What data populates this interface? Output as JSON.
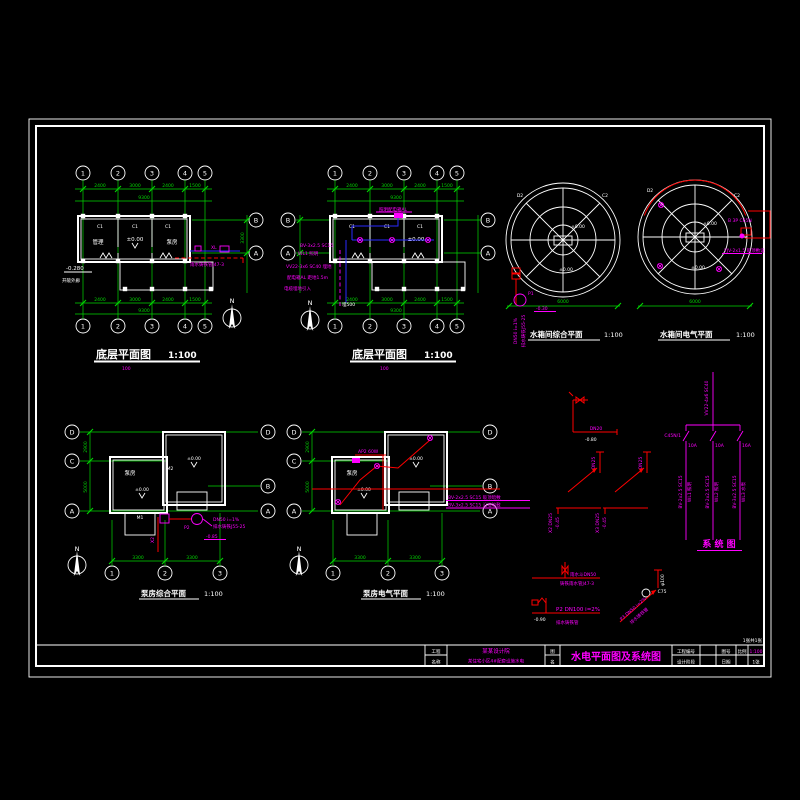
{
  "frame": {
    "pages_note": "1张共1张"
  },
  "titleblock": {
    "c1r1": "工程",
    "c1r2": "名称",
    "company1": "某某设计院",
    "company2": "某住宅小区4#配套设施水电",
    "c2r1": "图",
    "c2r2": "名",
    "drawing_title": "水电平面图及系统图",
    "f1": "工程编号",
    "f1v": "",
    "f2": "图号",
    "f2v": "",
    "f3": "比例",
    "f3v": "1:100",
    "f4": "设计阶段",
    "f4v": "",
    "f5": "日期",
    "f5v": "",
    "f6v": "1张"
  },
  "pa": {
    "title": "底层平面图",
    "scale": "1:100",
    "sub": "100",
    "grid": [
      "1",
      "2",
      "3",
      "4",
      "5"
    ],
    "gridR": [
      "B",
      "A"
    ],
    "dims_top": [
      "2400",
      "3000",
      "2400",
      "1500"
    ],
    "total_top": "9300",
    "dims_bot": [
      "2400",
      "3000",
      "2400",
      "1500"
    ],
    "total_bot": "9300",
    "side_dim": "3300",
    "win": "C1",
    "room1": "管理",
    "room2": "泵房",
    "lvl0": "±0.00",
    "lvlm": "-0.280",
    "porch": "开敞外廊",
    "note_xl": "XL",
    "note_rain": "雨水铸铁管J47-3",
    "north": "N"
  },
  "pb": {
    "title": "底层平面图",
    "scale": "1:100",
    "sub": "100",
    "grid": [
      "1",
      "2",
      "3",
      "4",
      "5"
    ],
    "gridL": [
      "B",
      "A"
    ],
    "gridR": [
      "B",
      "A"
    ],
    "dims_top": [
      "2400",
      "3000",
      "2400",
      "1500"
    ],
    "total_top": "9300",
    "dims_bot": [
      "2400",
      "3000",
      "2400",
      "1500"
    ],
    "total_bot": "9300",
    "win": "C1",
    "lvl0": "±0.00",
    "box_label": "照明配电箱AL",
    "n1": "BV-3x2.5 SC15",
    "n2": "WL1 照明",
    "n3": "VV22-3x6 SC40 埋地",
    "n4": "配电箱AL 距地1.5m",
    "n5": "电缆埋地引入",
    "n6": "埋500",
    "north": "N"
  },
  "tl": {
    "title": "水箱间综合平面",
    "scale": "1:100",
    "d2": "D2",
    "c2": "C2",
    "lvl": "±0.00",
    "dim": "6000",
    "p1": "P1",
    "lvlm": "-0.30",
    "v1": "DN50 i=1%",
    "v2": "排水铸铁J55-25"
  },
  "tr": {
    "title": "水箱间电气平面",
    "scale": "1:100",
    "d2": "D2",
    "c2": "C2",
    "lvl": "±0.00",
    "dim": "6000",
    "n1": "B 3P C65N",
    "n2": "YJV-2x1.5 吸顶敷设"
  },
  "pc": {
    "title": "泵房综合平面",
    "scale": "1:100",
    "gridL": [
      "D",
      "C",
      "A"
    ],
    "gridR": [
      "D",
      "B",
      "A"
    ],
    "gridB": [
      "1",
      "2",
      "3"
    ],
    "dims_bot": [
      "3300",
      "3300"
    ],
    "side1": "2900",
    "side2": "5000",
    "room": "泵房",
    "lvl0": "±0.00",
    "m1": "M1",
    "m2": "M2",
    "p2": "P2",
    "x2": "X2",
    "n1": "DN50 i=1%",
    "n2": "排水铸铁J55-25",
    "lvlm": "-0.85",
    "north": "N"
  },
  "pd": {
    "title": "泵房电气平面",
    "scale": "1:100",
    "gridL": [
      "D",
      "C",
      "A"
    ],
    "gridR": [
      "D",
      "B",
      "A"
    ],
    "gridB": [
      "1",
      "2",
      "3"
    ],
    "dims_bot": [
      "3300",
      "3300"
    ],
    "side1": "2900",
    "side2": "5000",
    "room": "泵房",
    "lvl0": "±0.00",
    "ap": "AP2 60W",
    "n1": "BV-2x2.5 SC15 吸顶暗敷",
    "n2": "BV-3x2.5 SC15 沿墙暗敷",
    "north": "N"
  },
  "sys": {
    "title": "系 统 图",
    "feed": "VV22-4x6 SC40",
    "brk": "C45N/1",
    "amps": [
      "10A",
      "10A",
      "16A"
    ],
    "wires": [
      "BV-2x2.5 SC15",
      "BV-2x2.5 SC15",
      "BV-3x2.5 SC15"
    ],
    "loads": [
      "WL1 照明",
      "WL2 照明",
      "WL3 水泵"
    ]
  },
  "dt": {
    "d1a": "DN20",
    "d1b": "-0.80",
    "r1a": "DN25",
    "r1b": "X2 DN25",
    "r1c": "-0.45",
    "r2a": "DN25",
    "r2b": "X3 DN25",
    "r2c": "-0.45",
    "rain1": "雨水斗DN50",
    "rain2": "铸铁雨水管J47-3",
    "p2": "P2 DN100 i=2%",
    "p2lvl": "-0.90",
    "p2n": "排水铸铁管",
    "dia1": "φ100",
    "dia2": "C75",
    "dia3": "P3 DN50 i=2%",
    "dia4": "排水铸铁管"
  }
}
